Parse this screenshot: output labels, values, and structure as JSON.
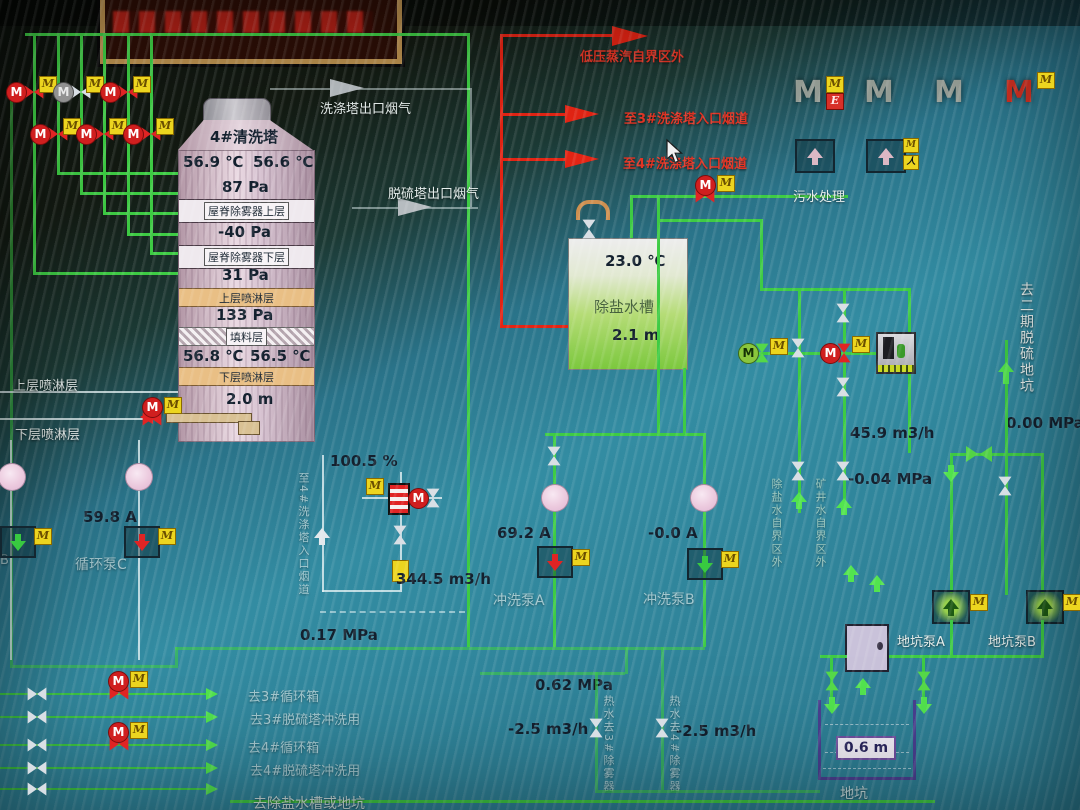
{
  "glyphs": {
    "m": "M",
    "e": "E",
    "person": "人"
  },
  "tower": {
    "name": "4#清洗塔",
    "t_top_left": "56.9 ℃",
    "t_top_right": "56.6 ℃",
    "pa_top": "87 Pa",
    "demister_upper": "屋脊除雾器上层",
    "pa_between": "-40 Pa",
    "demister_lower": "屋脊除雾器下层",
    "pa_below": "31 Pa",
    "spray_upper": "上层喷淋层",
    "pa_spray": "133 Pa",
    "packing": "填料层",
    "t_bot_left": "56.8 ℃",
    "t_bot_right": "56.5 ℃",
    "spray_lower": "下层喷淋层",
    "level": "2.0 m"
  },
  "side_labels": {
    "spray_upper": "上层喷淋层",
    "spray_lower": "下层喷淋层"
  },
  "flue": {
    "scrubber_out": "洗涤塔出口烟气",
    "desulf_out": "脱硫塔出口烟气"
  },
  "steam": {
    "line1": "低压蒸汽自界区外",
    "line2": "至3#洗涤塔入口烟道",
    "line3": "至4#洗涤塔入口烟道"
  },
  "tank": {
    "temp": "23.0 ℃",
    "name": "除盐水槽",
    "level": "2.1 m"
  },
  "sewage": {
    "label": "污水处理"
  },
  "valve_group": {
    "opening": "100.5 %",
    "duct": "至4#洗涤塔入口烟道",
    "flow": "344.5 m3/h",
    "pressure": "0.17 MPa"
  },
  "pumps": {
    "circ_b_part": "B",
    "circ_c_current": "59.8 A",
    "circ_c": "循环泵C",
    "flush_a_current": "69.2 A",
    "flush_a": "冲洗泵A",
    "flush_b_current": "-0.0 A",
    "flush_b": "冲洗泵B",
    "pit_a": "地坑泵A",
    "pit_b": "地坑泵B"
  },
  "right": {
    "flow": "45.9 m3/h",
    "vacuum": "-0.04 MPa",
    "demin_src": "除盐水自界区外",
    "mine_src": "矿井水自界区外",
    "dest": "去二期脱硫地坑",
    "pressure": "0.00 MPa"
  },
  "bottom": {
    "pressure": "0.62 MPa",
    "flow_left": "-2.5 m3/h",
    "flow_right": "-2.5 m3/h",
    "duct3": "热水去3#除雾器",
    "duct4": "热水去4#除雾器"
  },
  "rows": [
    "去3#循环箱",
    "去3#脱硫塔冲洗用",
    "去4#循环箱",
    "去4#脱硫塔冲洗用",
    "去除盐水槽或地坑"
  ],
  "pit": {
    "level": "0.6 m",
    "name": "地坑"
  },
  "colors": {
    "pipe_green": "#3ecb44",
    "pipe_red": "#e32414",
    "tank_green": "#7cc83e",
    "valve_yellow": "#ecd51f"
  }
}
